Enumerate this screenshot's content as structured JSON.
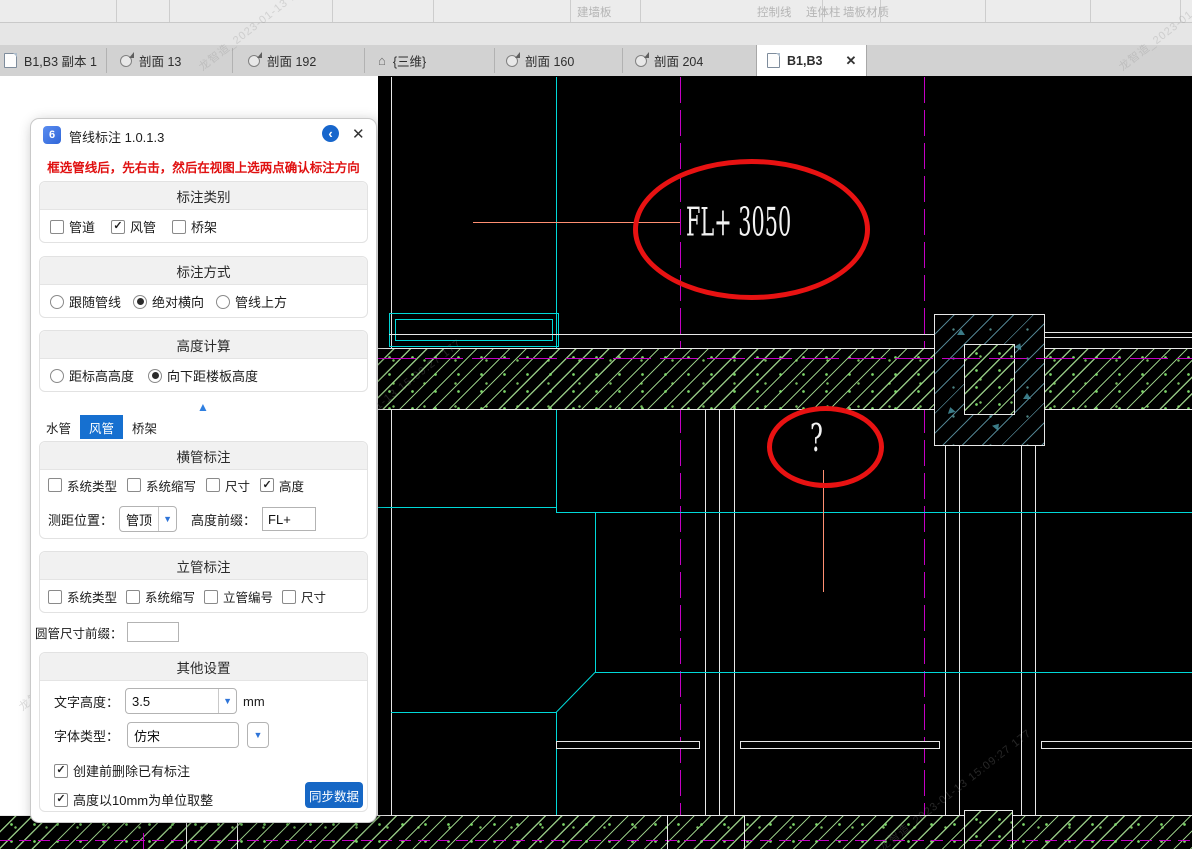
{
  "top_toolbar": {
    "labels": [
      {
        "text": "建墙板"
      },
      {
        "text": "墙板材质"
      },
      {
        "text": "控制线"
      },
      {
        "text": "连体柱"
      }
    ]
  },
  "tab_bar": {
    "tabs": [
      {
        "label": "B1,B3 副本 1",
        "icon": "plan",
        "active": false
      },
      {
        "label": "剖面 13",
        "icon": "section",
        "active": false
      },
      {
        "label": "剖面 192",
        "icon": "section",
        "active": false
      },
      {
        "label": "{三维}",
        "icon": "3d",
        "active": false
      },
      {
        "label": "剖面 160",
        "icon": "section",
        "active": false
      },
      {
        "label": "剖面 204",
        "icon": "section",
        "active": false
      },
      {
        "label": "B1,B3",
        "icon": "plan",
        "active": true
      }
    ],
    "close_glyph": "✕"
  },
  "dialog": {
    "title": "管线标注 1.0.1.3",
    "icon_glyph": "6",
    "back_glyph": "‹",
    "close_glyph": "✕",
    "warning": "框选管线后，先右击，然后在视图上选两点确认标注方向",
    "category_section": {
      "title": "标注类别",
      "options": [
        {
          "label": "管道",
          "checked": false
        },
        {
          "label": "风管",
          "checked": true
        },
        {
          "label": "桥架",
          "checked": false
        }
      ]
    },
    "method_section": {
      "title": "标注方式",
      "options": [
        {
          "label": "跟随管线",
          "selected": false
        },
        {
          "label": "绝对横向",
          "selected": true
        },
        {
          "label": "管线上方",
          "selected": false
        }
      ]
    },
    "height_calc_section": {
      "title": "高度计算",
      "options": [
        {
          "label": "距标高高度",
          "selected": false
        },
        {
          "label": "向下距楼板高度",
          "selected": true
        }
      ]
    },
    "collapse_glyph": "▲",
    "pipe_tabs": [
      {
        "label": "水管",
        "active": false
      },
      {
        "label": "风管",
        "active": true
      },
      {
        "label": "桥架",
        "active": false
      }
    ],
    "horizontal_section": {
      "title": "横管标注",
      "checkboxes": [
        {
          "label": "系统类型",
          "checked": false
        },
        {
          "label": "系统缩写",
          "checked": false
        },
        {
          "label": "尺寸",
          "checked": false
        },
        {
          "label": "高度",
          "checked": true
        }
      ],
      "measure_label": "测距位置：",
      "measure_value": "管顶",
      "prefix_label": "高度前缀：",
      "prefix_value": "FL+"
    },
    "riser_section": {
      "title": "立管标注",
      "checkboxes": [
        {
          "label": "系统类型",
          "checked": false
        },
        {
          "label": "系统缩写",
          "checked": false
        },
        {
          "label": "立管编号",
          "checked": false
        },
        {
          "label": "尺寸",
          "checked": false
        }
      ]
    },
    "round_prefix_label": "圆管尺寸前缀：",
    "round_prefix_value": "",
    "other_section": {
      "title": "其他设置",
      "text_height_label": "文字高度：",
      "text_height_value": "3.5",
      "text_height_unit": "mm",
      "font_label": "字体类型：",
      "font_value": "仿宋",
      "checkbox1": {
        "label": "创建前删除已有标注",
        "checked": true
      },
      "checkbox2": {
        "label": "高度以10mm为单位取整",
        "checked": true
      },
      "sync_button": "同步数据"
    }
  },
  "canvas": {
    "level_annotation": "FL+ 3050",
    "question_mark": "?"
  },
  "watermark": {
    "text": "龙智造_2023-01-13 15:09:27 177"
  },
  "colors": {
    "accent_blue": "#1766cc",
    "cad_cyan": "#00d9d9",
    "cad_magenta": "#c400c4",
    "cad_green": "#8fd98f",
    "cad_teal": "#5a9aae",
    "cad_red": "#e81212",
    "cad_salmon": "#ff8f72",
    "warning_red": "#e01010"
  }
}
